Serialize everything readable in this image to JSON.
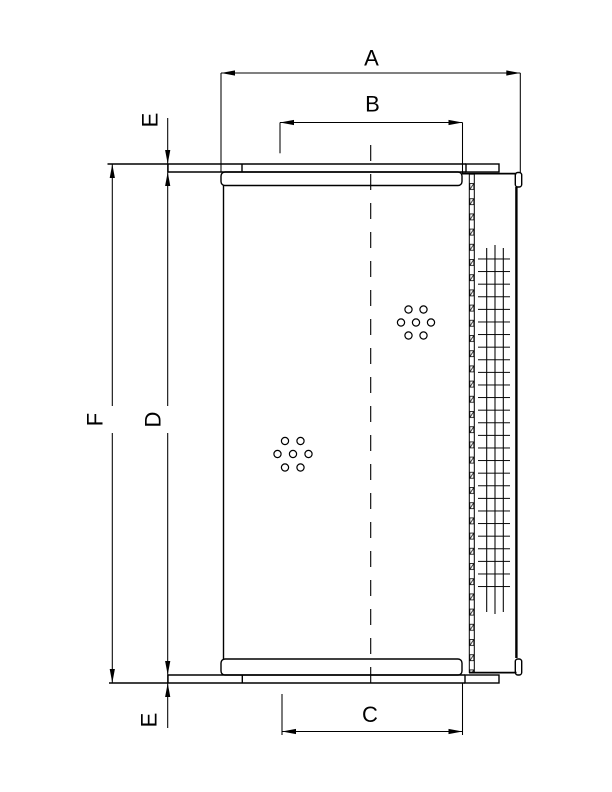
{
  "drawing": {
    "type": "technical-dimension-drawing",
    "subject": "cylindrical filter element side/section view",
    "colors": {
      "line": "#000000",
      "background": "#ffffff"
    },
    "labels": {
      "a": "A",
      "b": "B",
      "c": "C",
      "d": "D",
      "f": "F",
      "e_top": "E",
      "e_bottom": "E"
    }
  }
}
